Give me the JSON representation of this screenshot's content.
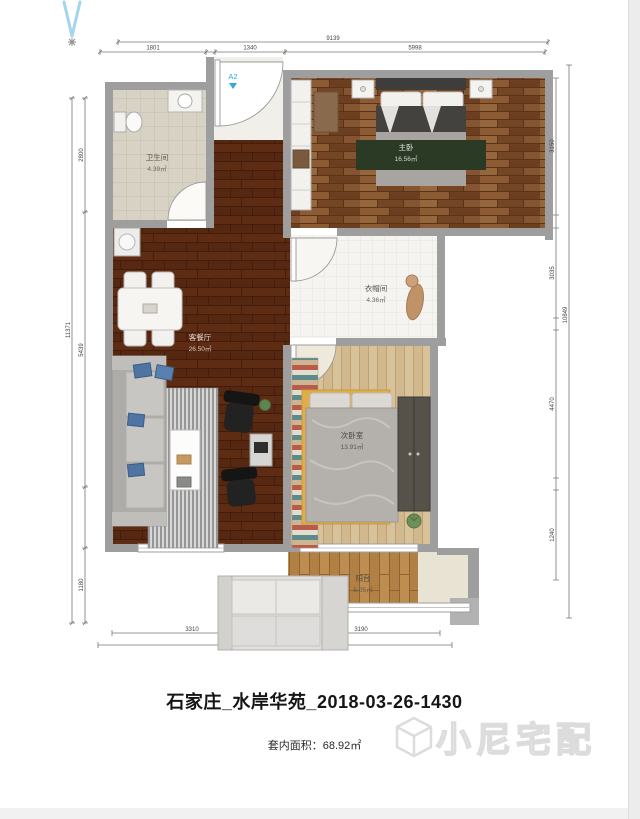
{
  "page": {
    "title": "石家庄_水岸华苑_2018-03-26-1430",
    "area_caption": "套内面积：68.92㎡"
  },
  "watermark": {
    "text": "小尼宅配",
    "icon": "cube-logo"
  },
  "entry": {
    "door_label": "A2"
  },
  "rooms": {
    "bathroom": {
      "name": "卫生间",
      "area": "4.39㎡"
    },
    "master_bedroom": {
      "name": "主卧",
      "area": "16.56㎡"
    },
    "cloakroom": {
      "name": "衣帽间",
      "area": "4.36㎡"
    },
    "living_dining": {
      "name": "客餐厅",
      "area": "26.50㎡"
    },
    "second_bedroom": {
      "name": "次卧室",
      "area": "13.91㎡"
    },
    "balcony": {
      "name": "阳台",
      "area": "5.05㎡"
    }
  },
  "dimensions": {
    "top": {
      "total": "9139",
      "segments": [
        "1801",
        "1340",
        "5998"
      ]
    },
    "left": {
      "total": "11371",
      "segments": [
        "2800",
        "5439",
        "1180"
      ]
    },
    "right": {
      "total": "10849",
      "segments": [
        "3150",
        "3035",
        "4470",
        "1240"
      ]
    },
    "bottom": {
      "total": "7180",
      "segments": [
        "3310",
        "3190"
      ]
    }
  },
  "colors": {
    "wall": "#9e9e9e",
    "accent_blue": "#2da8dc",
    "living_floor": "#572811",
    "master_floor": "#7e4d2a",
    "rug_green": "#2b3a24",
    "rug_yellow": "#dfad49"
  }
}
